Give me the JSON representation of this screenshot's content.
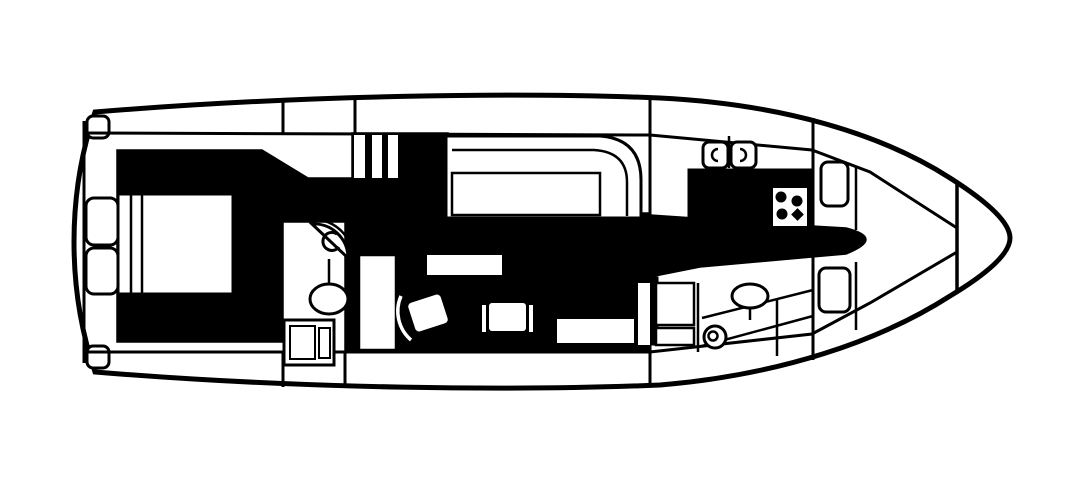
{
  "diagram": {
    "type": "yacht-interior-deck-plan",
    "orientation": "bow-right-stern-left",
    "style": "black-and-white line drawing, top-down floor plan, walkway sole filled solid black",
    "colors": {
      "ink": "#000000",
      "paper": "#ffffff",
      "walkway_fill": "#000000"
    },
    "rooms": [
      {
        "name": "aft-deck",
        "features": [
          "transom",
          "corner-steps"
        ]
      },
      {
        "name": "aft-stateroom",
        "features": [
          "double-berth",
          "headboard",
          "nightstand-upper",
          "nightstand-lower"
        ]
      },
      {
        "name": "aft-head",
        "features": [
          "fan-vanity-sink",
          "toilet",
          "shower-stall"
        ]
      },
      {
        "name": "companionway",
        "features": [
          "three-steps"
        ]
      },
      {
        "name": "salon",
        "features": [
          "l-settee",
          "seat-cushion",
          "coffee-table",
          "swivel-chair-left",
          "swivel-chair-right",
          "bench-seat"
        ]
      },
      {
        "name": "galley",
        "features": [
          "double-sink",
          "counter",
          "stove-four-burner"
        ]
      },
      {
        "name": "forward-cabin",
        "features": [
          "berth",
          "locker-top",
          "locker-bottom"
        ]
      },
      {
        "name": "forward-head",
        "features": [
          "oval-sink",
          "round-toilet"
        ]
      },
      {
        "name": "side-decks",
        "features": [
          "port-walkway-band",
          "starboard-walkway-band",
          "bulkhead-dividers"
        ]
      },
      {
        "name": "bow",
        "features": [
          "pulpit-platform",
          "bow-bulkhead",
          "converging-deck-lines"
        ]
      }
    ]
  }
}
